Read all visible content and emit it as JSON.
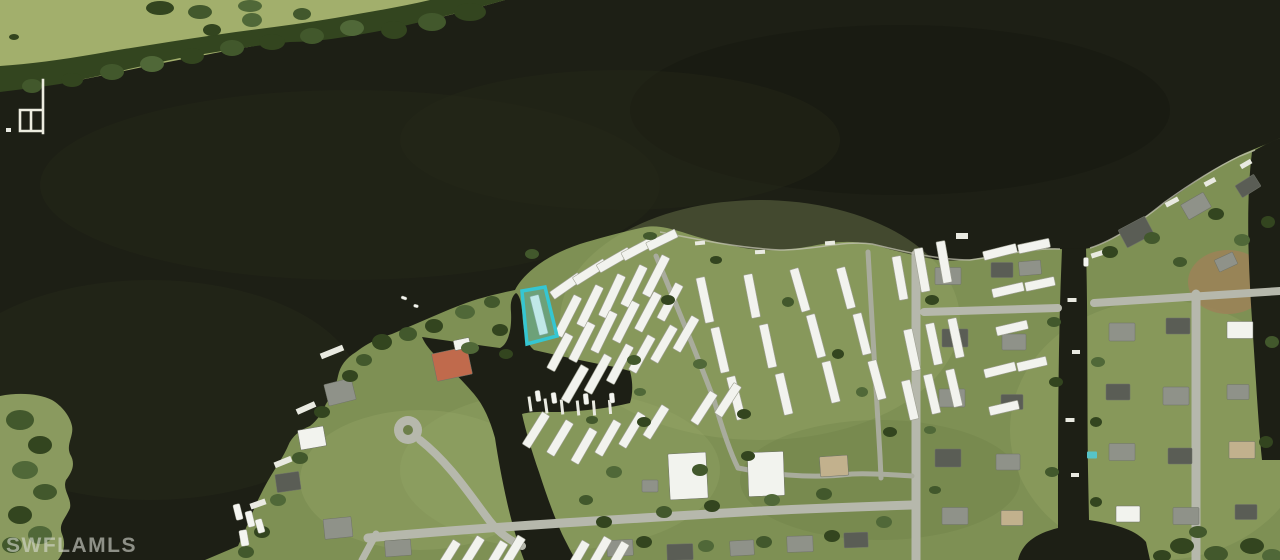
{
  "meta": {
    "type": "aerial-satellite-photo",
    "description": "Aerial MLS listing photo: dark river around a mobile home park peninsula with marina, canals and suburban streets; subject parcel outlined in cyan"
  },
  "watermark": {
    "text": "SWFLAMLS"
  },
  "highlight": {
    "label": "subject-parcel",
    "points": "522,291 545,287 557,336 527,344",
    "stroke": "#35C6D2",
    "fill": "rgba(64,206,220,0.28)",
    "stroke_width": "3.5"
  },
  "palette": {
    "water": "#1d1f15",
    "field": "#a2af6c",
    "grass": "#7e9054",
    "grass_light": "#9dad6c",
    "tree0": "#33451f",
    "tree1": "#42582c",
    "tree2": "#506838",
    "road": "#b6b8ac",
    "lane": "#a9ac9d",
    "roof_white": "#f2f3ee",
    "roof_gray": "#8f9289",
    "roof_dark": "#5a5d55",
    "roof_tan": "#c2b18d",
    "roof_red": "#c06a4c",
    "dock": "#e9eae1",
    "seawall": "#c3c3b1",
    "pool": "#56c4c8",
    "highlight": "#35c6d2"
  },
  "features": {
    "trailers": [
      [
        566,
        286,
        34,
        -35
      ],
      [
        590,
        272,
        36,
        -32
      ],
      [
        614,
        260,
        36,
        -30
      ],
      [
        638,
        249,
        34,
        -28
      ],
      [
        662,
        240,
        32,
        -26
      ],
      [
        568,
        316,
        44,
        -63
      ],
      [
        590,
        306,
        44,
        -64
      ],
      [
        612,
        296,
        46,
        -65
      ],
      [
        634,
        286,
        44,
        -64
      ],
      [
        656,
        276,
        44,
        -63
      ],
      [
        560,
        352,
        40,
        -62
      ],
      [
        582,
        342,
        42,
        -63
      ],
      [
        604,
        332,
        44,
        -64
      ],
      [
        626,
        322,
        44,
        -63
      ],
      [
        648,
        312,
        42,
        -62
      ],
      [
        670,
        302,
        40,
        -62
      ],
      [
        575,
        384,
        40,
        -60
      ],
      [
        598,
        374,
        42,
        -61
      ],
      [
        620,
        364,
        42,
        -62
      ],
      [
        642,
        354,
        40,
        -61
      ],
      [
        664,
        344,
        40,
        -60
      ],
      [
        686,
        334,
        38,
        -60
      ],
      [
        539,
        315,
        40,
        76
      ],
      [
        705,
        300,
        46,
        78
      ],
      [
        720,
        350,
        46,
        77
      ],
      [
        736,
        398,
        44,
        76
      ],
      [
        752,
        296,
        44,
        79
      ],
      [
        768,
        346,
        44,
        78
      ],
      [
        784,
        394,
        42,
        77
      ],
      [
        800,
        290,
        44,
        74
      ],
      [
        816,
        336,
        44,
        75
      ],
      [
        831,
        382,
        42,
        76
      ],
      [
        846,
        288,
        42,
        75
      ],
      [
        862,
        334,
        42,
        76
      ],
      [
        877,
        380,
        40,
        75
      ],
      [
        900,
        278,
        44,
        80
      ],
      [
        922,
        270,
        44,
        80
      ],
      [
        944,
        262,
        42,
        80
      ],
      [
        1000,
        252,
        34,
        -14
      ],
      [
        1034,
        246,
        32,
        -12
      ],
      [
        1008,
        290,
        32,
        -13
      ],
      [
        1040,
        284,
        30,
        -12
      ],
      [
        1012,
        328,
        32,
        -13
      ],
      [
        912,
        350,
        42,
        78
      ],
      [
        934,
        344,
        42,
        78
      ],
      [
        956,
        338,
        40,
        78
      ],
      [
        910,
        400,
        40,
        77
      ],
      [
        932,
        394,
        40,
        77
      ],
      [
        954,
        388,
        38,
        77
      ],
      [
        1000,
        370,
        32,
        -14
      ],
      [
        1032,
        364,
        30,
        -13
      ],
      [
        1004,
        408,
        30,
        -13
      ],
      [
        536,
        430,
        38,
        -58
      ],
      [
        560,
        438,
        38,
        -59
      ],
      [
        584,
        446,
        38,
        -60
      ],
      [
        608,
        438,
        38,
        -60
      ],
      [
        632,
        430,
        38,
        -59
      ],
      [
        656,
        422,
        36,
        -58
      ],
      [
        704,
        408,
        36,
        -57
      ],
      [
        728,
        400,
        36,
        -57
      ],
      [
        448,
        556,
        34,
        -58
      ],
      [
        472,
        552,
        34,
        -58
      ],
      [
        496,
        556,
        32,
        -59
      ],
      [
        514,
        550,
        30,
        -59
      ],
      [
        578,
        556,
        32,
        -60
      ],
      [
        600,
        552,
        32,
        -60
      ],
      [
        618,
        556,
        30,
        -60
      ]
    ],
    "houses": [
      [
        948,
        276,
        26,
        17,
        0,
        "g"
      ],
      [
        1002,
        270,
        22,
        15,
        0,
        "d"
      ],
      [
        955,
        338,
        26,
        18,
        0,
        "d"
      ],
      [
        1014,
        342,
        24,
        16,
        0,
        "g"
      ],
      [
        952,
        398,
        26,
        18,
        0,
        "g"
      ],
      [
        1012,
        402,
        22,
        15,
        0,
        "d"
      ],
      [
        948,
        458,
        26,
        18,
        0,
        "d"
      ],
      [
        1008,
        462,
        24,
        16,
        0,
        "g"
      ],
      [
        955,
        516,
        26,
        17,
        0,
        "g"
      ],
      [
        1012,
        518,
        22,
        15,
        0,
        "t"
      ],
      [
        1122,
        332,
        26,
        18,
        0,
        "g"
      ],
      [
        1178,
        326,
        24,
        16,
        0,
        "d"
      ],
      [
        1240,
        330,
        26,
        17,
        0,
        "w"
      ],
      [
        1118,
        392,
        24,
        16,
        0,
        "d"
      ],
      [
        1176,
        396,
        26,
        18,
        0,
        "g"
      ],
      [
        1238,
        392,
        22,
        15,
        0,
        "g"
      ],
      [
        1122,
        452,
        26,
        17,
        0,
        "g"
      ],
      [
        1180,
        456,
        24,
        16,
        0,
        "d"
      ],
      [
        1242,
        450,
        26,
        17,
        0,
        "t"
      ],
      [
        1128,
        514,
        24,
        16,
        0,
        "w"
      ],
      [
        1186,
        516,
        26,
        17,
        0,
        "g"
      ],
      [
        1246,
        512,
        22,
        15,
        0,
        "d"
      ],
      [
        1136,
        232,
        30,
        20,
        -28,
        "d"
      ],
      [
        1196,
        206,
        26,
        17,
        -30,
        "g"
      ],
      [
        1248,
        186,
        22,
        14,
        -32,
        "d"
      ],
      [
        1226,
        262,
        20,
        13,
        -25,
        "g"
      ],
      [
        1030,
        268,
        22,
        14,
        -5,
        "g"
      ],
      [
        688,
        476,
        38,
        46,
        -3,
        "w"
      ],
      [
        766,
        474,
        36,
        44,
        -2,
        "w"
      ],
      [
        834,
        466,
        28,
        20,
        -4,
        "t"
      ],
      [
        650,
        486,
        16,
        12,
        0,
        "g"
      ],
      [
        452,
        364,
        36,
        28,
        -12,
        "r"
      ],
      [
        340,
        392,
        28,
        22,
        -14,
        "g"
      ],
      [
        312,
        438,
        26,
        20,
        -10,
        "w"
      ],
      [
        288,
        482,
        24,
        18,
        -8,
        "d"
      ],
      [
        338,
        528,
        28,
        20,
        -6,
        "g"
      ],
      [
        398,
        548,
        26,
        16,
        -4,
        "g"
      ],
      [
        462,
        344,
        16,
        10,
        -12,
        "w"
      ],
      [
        620,
        548,
        26,
        16,
        -3,
        "g"
      ],
      [
        680,
        552,
        26,
        16,
        -2,
        "d"
      ],
      [
        742,
        548,
        24,
        15,
        -3,
        "g"
      ],
      [
        800,
        544,
        26,
        16,
        -2,
        "g"
      ],
      [
        856,
        540,
        24,
        15,
        -2,
        "d"
      ]
    ],
    "trees": [
      [
        470,
        12,
        16,
        9,
        0
      ],
      [
        432,
        22,
        14,
        9,
        1
      ],
      [
        394,
        30,
        13,
        9,
        0
      ],
      [
        352,
        28,
        12,
        8,
        2
      ],
      [
        312,
        36,
        12,
        8,
        1
      ],
      [
        272,
        42,
        13,
        8,
        0
      ],
      [
        232,
        48,
        12,
        8,
        1
      ],
      [
        192,
        56,
        12,
        8,
        0
      ],
      [
        152,
        64,
        12,
        8,
        2
      ],
      [
        112,
        72,
        12,
        8,
        1
      ],
      [
        72,
        80,
        11,
        7,
        0
      ],
      [
        32,
        86,
        10,
        7,
        1
      ],
      [
        252,
        20,
        10,
        7,
        2
      ],
      [
        302,
        14,
        9,
        6,
        1
      ],
      [
        212,
        30,
        9,
        6,
        0
      ],
      [
        160,
        8,
        14,
        7,
        0
      ],
      [
        200,
        12,
        12,
        7,
        1
      ],
      [
        250,
        6,
        12,
        6,
        2
      ],
      [
        14,
        37,
        5,
        3,
        0
      ],
      [
        382,
        342,
        10,
        8,
        0
      ],
      [
        408,
        334,
        9,
        7,
        1
      ],
      [
        434,
        326,
        9,
        7,
        0
      ],
      [
        465,
        312,
        10,
        7,
        2
      ],
      [
        492,
        302,
        8,
        6,
        1
      ],
      [
        500,
        330,
        8,
        6,
        0
      ],
      [
        470,
        348,
        9,
        6,
        2
      ],
      [
        364,
        360,
        8,
        6,
        1
      ],
      [
        350,
        376,
        8,
        6,
        0
      ],
      [
        532,
        254,
        7,
        5,
        1
      ],
      [
        668,
        300,
        7,
        5,
        0
      ],
      [
        700,
        364,
        7,
        5,
        2
      ],
      [
        744,
        414,
        7,
        5,
        0
      ],
      [
        788,
        302,
        6,
        5,
        1
      ],
      [
        838,
        354,
        6,
        5,
        0
      ],
      [
        862,
        392,
        6,
        5,
        2
      ],
      [
        890,
        432,
        7,
        5,
        0
      ],
      [
        700,
        470,
        8,
        6,
        1
      ],
      [
        748,
        456,
        7,
        5,
        0
      ],
      [
        640,
        392,
        6,
        4,
        2
      ],
      [
        592,
        420,
        6,
        4,
        1
      ],
      [
        716,
        260,
        6,
        4,
        0
      ],
      [
        650,
        236,
        7,
        4,
        1
      ],
      [
        604,
        522,
        8,
        6,
        0
      ],
      [
        664,
        512,
        8,
        6,
        1
      ],
      [
        712,
        506,
        8,
        6,
        0
      ],
      [
        772,
        500,
        8,
        6,
        2
      ],
      [
        824,
        494,
        8,
        6,
        1
      ],
      [
        644,
        542,
        8,
        6,
        0
      ],
      [
        706,
        546,
        8,
        6,
        2
      ],
      [
        764,
        542,
        8,
        6,
        1
      ],
      [
        832,
        536,
        8,
        6,
        0
      ],
      [
        884,
        522,
        8,
        6,
        2
      ],
      [
        932,
        300,
        7,
        5,
        0
      ],
      [
        1054,
        322,
        7,
        5,
        1
      ],
      [
        1056,
        382,
        7,
        5,
        0
      ],
      [
        1098,
        362,
        7,
        5,
        2
      ],
      [
        1096,
        422,
        6,
        5,
        0
      ],
      [
        1052,
        472,
        7,
        5,
        1
      ],
      [
        1096,
        502,
        6,
        5,
        0
      ],
      [
        930,
        430,
        6,
        4,
        2
      ],
      [
        935,
        490,
        6,
        4,
        1
      ],
      [
        1110,
        252,
        8,
        6,
        0
      ],
      [
        1152,
        238,
        8,
        6,
        1
      ],
      [
        1216,
        214,
        8,
        6,
        0
      ],
      [
        1242,
        240,
        8,
        6,
        2
      ],
      [
        1180,
        262,
        7,
        5,
        1
      ],
      [
        1268,
        222,
        7,
        6,
        0
      ],
      [
        1272,
        342,
        7,
        6,
        1
      ],
      [
        1266,
        442,
        7,
        6,
        0
      ],
      [
        1182,
        546,
        12,
        8,
        0
      ],
      [
        1216,
        554,
        12,
        8,
        1
      ],
      [
        1252,
        546,
        12,
        8,
        0
      ],
      [
        1272,
        556,
        10,
        7,
        2
      ],
      [
        1198,
        532,
        9,
        6,
        1
      ],
      [
        1162,
        556,
        9,
        6,
        0
      ],
      [
        506,
        354,
        7,
        5,
        0
      ],
      [
        634,
        360,
        7,
        5,
        1
      ],
      [
        644,
        422,
        7,
        5,
        0
      ],
      [
        614,
        472,
        8,
        6,
        2
      ],
      [
        586,
        500,
        7,
        5,
        1
      ],
      [
        322,
        412,
        8,
        6,
        0
      ],
      [
        300,
        458,
        8,
        6,
        1
      ],
      [
        278,
        500,
        8,
        6,
        2
      ],
      [
        262,
        532,
        8,
        6,
        0
      ],
      [
        246,
        552,
        8,
        6,
        1
      ]
    ],
    "docks": [
      [
        332,
        352,
        24,
        6,
        -22
      ],
      [
        306,
        408,
        20,
        6,
        -24
      ],
      [
        283,
        462,
        18,
        6,
        -22
      ],
      [
        258,
        504,
        16,
        6,
        -20
      ],
      [
        530,
        404,
        3,
        15,
        -8
      ],
      [
        546,
        406,
        3,
        15,
        -8
      ],
      [
        562,
        407,
        3,
        15,
        -6
      ],
      [
        578,
        408,
        3,
        15,
        -6
      ],
      [
        594,
        408,
        3,
        15,
        -5
      ],
      [
        610,
        407,
        3,
        14,
        -5
      ],
      [
        1098,
        254,
        14,
        5,
        -18
      ],
      [
        1134,
        226,
        14,
        5,
        -24
      ],
      [
        1172,
        202,
        14,
        5,
        -28
      ],
      [
        1210,
        182,
        12,
        5,
        -28
      ],
      [
        1246,
        164,
        12,
        5,
        -30
      ],
      [
        1072,
        300,
        9,
        4,
        0
      ],
      [
        1076,
        352,
        8,
        4,
        0
      ],
      [
        1070,
        420,
        9,
        4,
        0
      ],
      [
        1075,
        475,
        8,
        4,
        0
      ],
      [
        700,
        243,
        10,
        4,
        -5
      ],
      [
        760,
        252,
        10,
        4,
        -3
      ],
      [
        830,
        243,
        10,
        4,
        -4
      ],
      [
        962,
        236,
        12,
        6,
        0
      ]
    ],
    "boats": [
      [
        238,
        512,
        7,
        16,
        -14
      ],
      [
        250,
        519,
        7,
        16,
        -14
      ],
      [
        260,
        526,
        7,
        14,
        -16
      ],
      [
        244,
        538,
        8,
        16,
        -10
      ],
      [
        538,
        396,
        5,
        11,
        -8
      ],
      [
        554,
        398,
        5,
        11,
        -8
      ],
      [
        586,
        399,
        5,
        11,
        -6
      ],
      [
        612,
        398,
        5,
        10,
        -5
      ],
      [
        404,
        298,
        6,
        3,
        20
      ],
      [
        416,
        306,
        5,
        3,
        15
      ],
      [
        1086,
        262,
        5,
        9,
        0
      ]
    ],
    "pools": [
      [
        1092,
        455,
        10,
        7
      ]
    ]
  }
}
